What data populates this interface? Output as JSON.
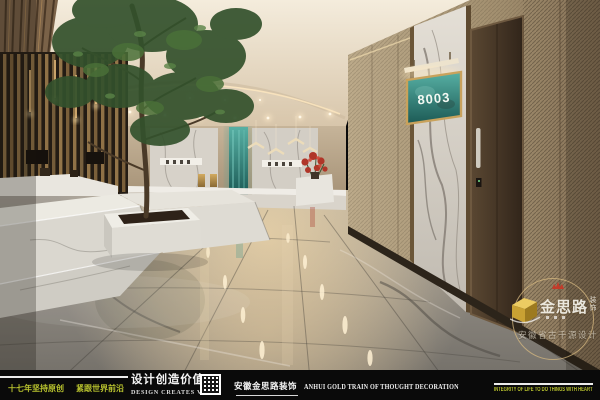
{
  "scene": {
    "door_sign": "8003"
  },
  "watermark": {
    "brand": "金思路",
    "brand_suffix": "装饰",
    "subtitle": "安徽省古千源设计",
    "logo_icon": "gold-blocks-logo",
    "badge_icon": "red-crown"
  },
  "footer": {
    "slogan_left_1": "十七年坚持原创",
    "slogan_left_2": "紧跟世界前沿",
    "slogan_center_cn": "设计创造价值",
    "slogan_center_en": "DESIGN CREATES VALUE",
    "company_cn": "安徽金思路装饰",
    "company_en": "ANHUI GOLD TRAIN OF THOUGHT DECORATION",
    "motto_right": "INTEGRITY OF LIFE TO DO THINGS WITH HEART",
    "qr_icon": "qr-code"
  },
  "colors": {
    "accent_green": "#b8c22e",
    "sign_teal": "#2f7a74",
    "frame_gold": "#c9a25c",
    "footer_bg": "#0a0a0a"
  }
}
